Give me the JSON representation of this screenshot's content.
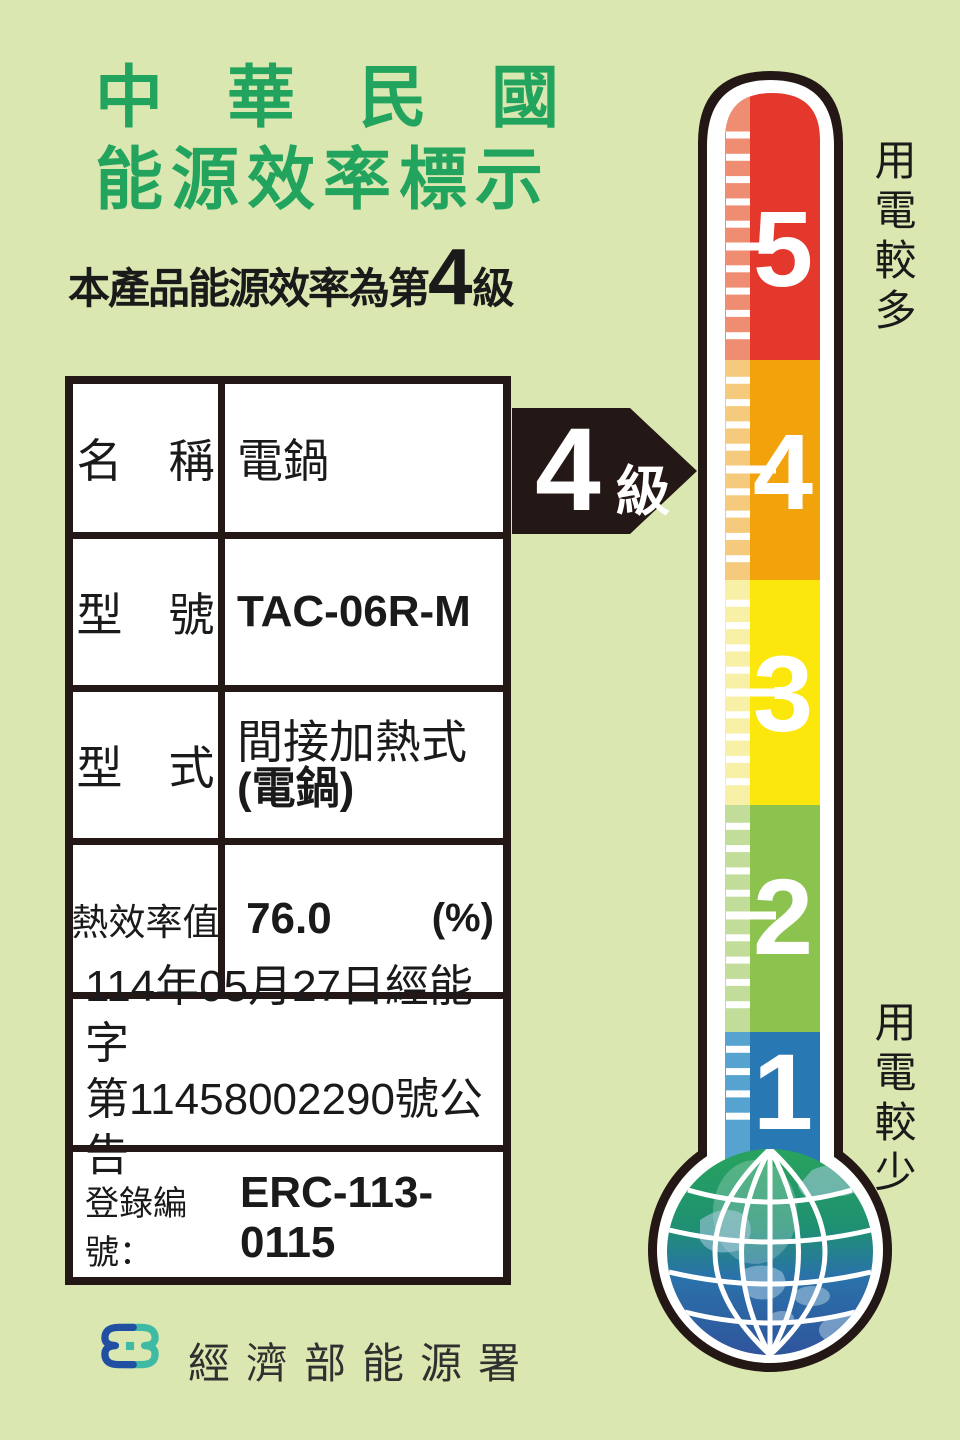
{
  "page": {
    "bg_color": "#dbe7b0"
  },
  "header": {
    "title_line1": "中華民國",
    "title_line2": "能源效率標示",
    "title_color": "#22a45e"
  },
  "subtitle": {
    "prefix": "本產品能源效率為第",
    "rating": "4",
    "suffix": "級"
  },
  "spec_table": {
    "rows": [
      {
        "label": "名　稱",
        "value": "電鍋"
      },
      {
        "label": "型　號",
        "value": "TAC-06R-M"
      },
      {
        "label": "型　式",
        "value_line1": "間接加熱式",
        "value_line2": "(電鍋)"
      },
      {
        "label": "熱效率值",
        "value": "76.0",
        "unit": "(%)"
      }
    ],
    "announcement_line1": "114年05月27日經能字",
    "announcement_line2": "第11458002290號公告",
    "registration": {
      "label": "登錄編號：",
      "value": "ERC-113-0115"
    }
  },
  "rating_arrow": {
    "rating": "4",
    "suffix": "級",
    "color": "#231815"
  },
  "thermometer": {
    "scale": [
      {
        "grade": "5",
        "color": "#e5382c",
        "stripe_color": "#ee8d72"
      },
      {
        "grade": "4",
        "color": "#f2a30c",
        "stripe_color": "#f6ca7c"
      },
      {
        "grade": "3",
        "color": "#fbe70c",
        "stripe_color": "#f9f0a8"
      },
      {
        "grade": "2",
        "color": "#8cc24e",
        "stripe_color": "#c2dc9a"
      },
      {
        "grade": "1",
        "color": "#2878b4",
        "stripe_color": "#55a3ce"
      }
    ],
    "label_more": "用電較多",
    "label_less": "用電較少"
  },
  "footer": {
    "agency": "經濟部能源署",
    "logo_blue": "#2150a3",
    "logo_teal": "#3fbaa4"
  }
}
